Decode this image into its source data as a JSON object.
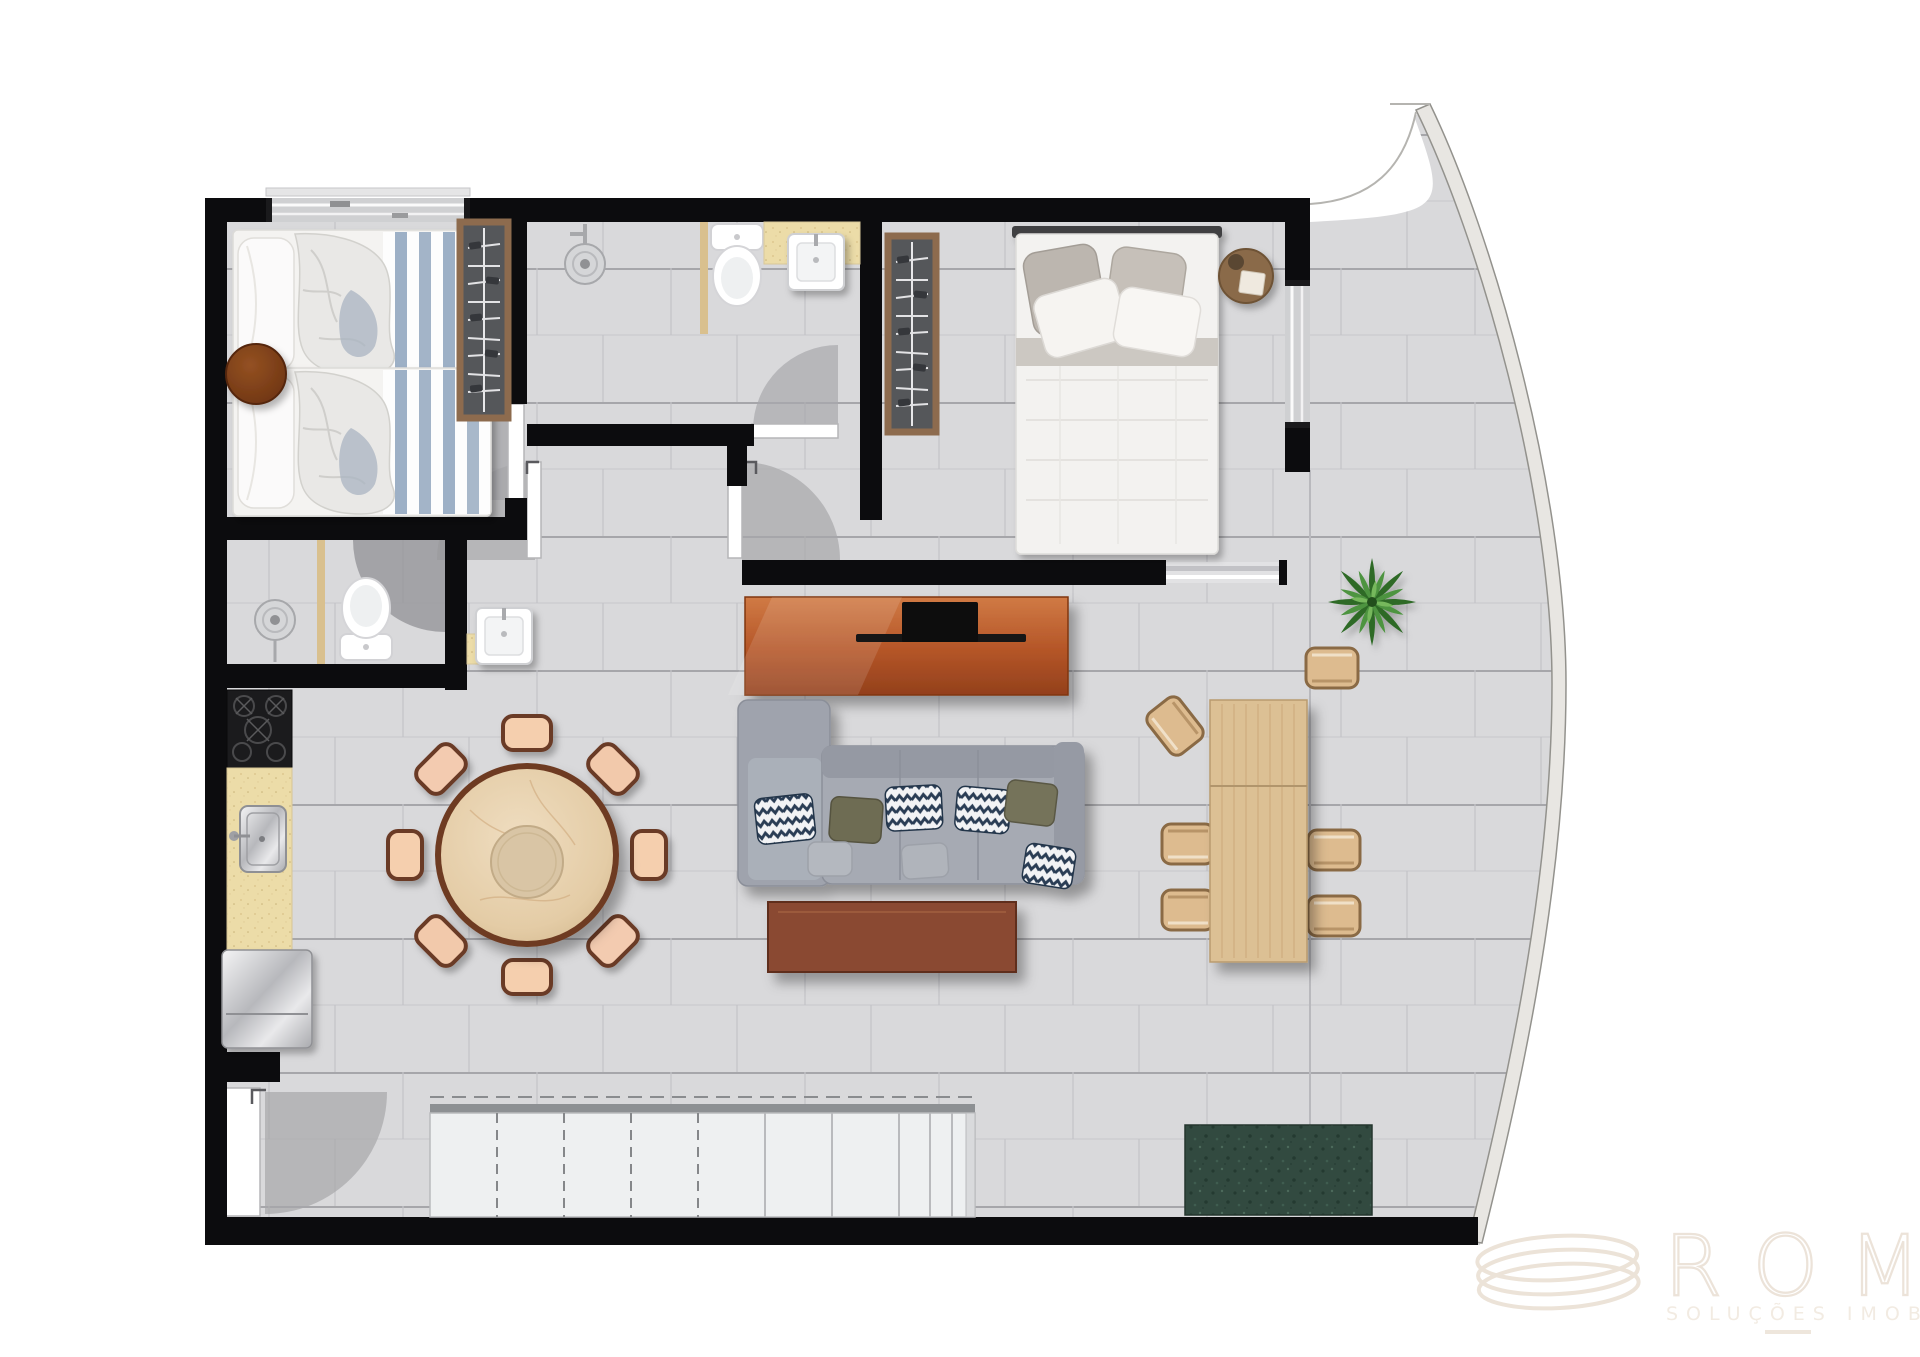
{
  "document": {
    "type": "apartment-floor-plan",
    "view": "top-down-rendered-plan"
  },
  "watermark": {
    "logo": "spiral-coil-logo",
    "brand": "ROMA",
    "tagline": "SOLUÇÕES IMOBILIÁRIAS"
  },
  "palette": {
    "background": "#ffffff",
    "wall": "#0c0c0e",
    "floor_tile": "#d9d9db",
    "tile_line_dark": "#a6a6aa",
    "tile_line_light": "#c8c8cb",
    "door_swing": "#a0a0a4",
    "wood_console": "#b85c2e",
    "wood_coffee_table": "#8a4a30",
    "wood_desk": "#dcc094",
    "wood_dark_round_table": "#7a3a16",
    "wardrobe_wood": "#8d6b4e",
    "wardrobe_interior": "#55575a",
    "sofa_gray": "#a6aab3",
    "cushion_chevron_navy": "#2c3e55",
    "cushion_olive": "#6e6c52",
    "chair_cushion_peach": "#f5cfae",
    "bed_linen_white": "#f4f3f1",
    "bed_stripe_blue": "#9db0c6",
    "counter_speckle": "#ecdca8",
    "stainless_steel": "#c9cacd",
    "granite_green": "#324a40",
    "plant_green": "#4e9440",
    "watermark_tone": "#ece3d8"
  },
  "rooms": [
    {
      "id": "bedroom-twin",
      "furniture": [
        "single-bed",
        "single-bed",
        "round-side-table",
        "wardrobe",
        "window"
      ]
    },
    {
      "id": "bathroom-top",
      "furniture": [
        "shower-head",
        "toilet",
        "washbasin-counter",
        "door-swing"
      ]
    },
    {
      "id": "bedroom-master",
      "furniture": [
        "double-bed",
        "wardrobe",
        "round-bedside-table",
        "window",
        "sliding-balcony-door"
      ]
    },
    {
      "id": "bathroom-mid",
      "furniture": [
        "shower-head",
        "toilet",
        "washbasin-counter",
        "door-swing"
      ]
    },
    {
      "id": "kitchen",
      "furniture": [
        "cooktop-4-burner",
        "counter-with-sink",
        "refrigerator"
      ]
    },
    {
      "id": "living-dining",
      "furniture": [
        "tv-console",
        "tv",
        "sofa-with-chaise",
        "coffee-table",
        "round-dining-table",
        "dining-chairs-x8"
      ]
    },
    {
      "id": "balcony-terrace",
      "furniture": [
        "wood-table",
        "wood-chairs-x6",
        "potted-plant",
        "granite-bench",
        "curved-glass-facade",
        "louvered-panels",
        "entry-door"
      ]
    }
  ]
}
